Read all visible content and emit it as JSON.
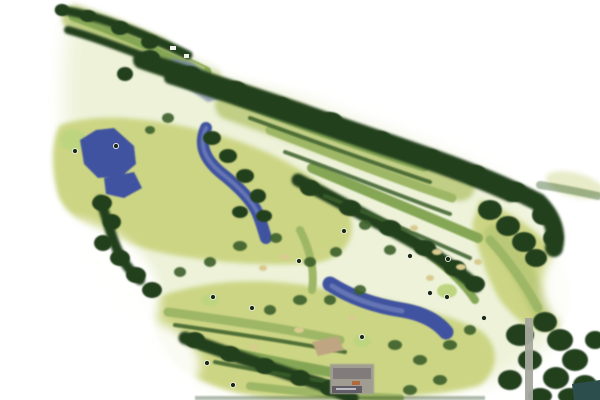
{
  "map": {
    "type": "golf-course-aerial-map",
    "description": "Watercolor-style overhead map of a wooded golf course running diagonally from upper-left to lower-right, with lakes, a creek, fairways, tree lines, a clubhouse at bottom center and a cart road at lower right",
    "palette": {
      "background": "#ffffff",
      "pale_wash": "#edf2d7",
      "land_light": "#ccd584",
      "land_mid": "#b8c876",
      "putting_green": "#bed57f",
      "fairway": "#85a755",
      "fairway_light": "#9eb766",
      "stripe_light": "#b7c97a",
      "trees_dark": "#24401b",
      "trees_mid": "#3a5f2c",
      "trees_light": "#567f3b",
      "water": "#4053a0",
      "water_light": "#8391c5",
      "shade_blue": "#7e8da9",
      "sand": "#d9cb90",
      "roof_gray": "#a09c92",
      "roof_tan": "#bfa582",
      "building_dark": "#5a5560",
      "sign_text_light": "#cfccd4",
      "sign_orange": "#b06a3c",
      "road_gray": "#a5a89e",
      "teal_dark": "#2c4f4e",
      "marker_dark": "#1b2a16",
      "white_speck": "#f0f1ea"
    },
    "features": {
      "water_bodies": [
        "lake-west",
        "pond-west",
        "creek-central",
        "lake-east",
        "pond-northeast-shaded"
      ],
      "vegetation": [
        "tree-band-north",
        "tree-fringe-first-hole",
        "tree-cluster-west",
        "tree-line-creek",
        "tree-band-central",
        "tree-band-south",
        "tree-cluster-east",
        "tree-cluster-southeast"
      ],
      "ground": [
        "fairway-first-hole",
        "fairway-corridors-upper",
        "fairway-corridors-lower",
        "open-rough-west",
        "open-rough-south",
        "putting-greens",
        "sand-bunkers"
      ],
      "structures": [
        "clubhouse-building",
        "outbuilding-tan",
        "clubhouse-sign",
        "cart-path-road",
        "teal-corner-structure",
        "small-structure-a",
        "small-structure-b"
      ]
    },
    "hole_markers": [
      {
        "x": 75,
        "y": 151
      },
      {
        "x": 116,
        "y": 146
      },
      {
        "x": 213,
        "y": 297
      },
      {
        "x": 207,
        "y": 363
      },
      {
        "x": 233,
        "y": 385
      },
      {
        "x": 252,
        "y": 308
      },
      {
        "x": 299,
        "y": 261
      },
      {
        "x": 344,
        "y": 231
      },
      {
        "x": 410,
        "y": 256
      },
      {
        "x": 448,
        "y": 259
      },
      {
        "x": 430,
        "y": 293
      },
      {
        "x": 447,
        "y": 297
      },
      {
        "x": 484,
        "y": 318
      },
      {
        "x": 362,
        "y": 337
      }
    ]
  }
}
